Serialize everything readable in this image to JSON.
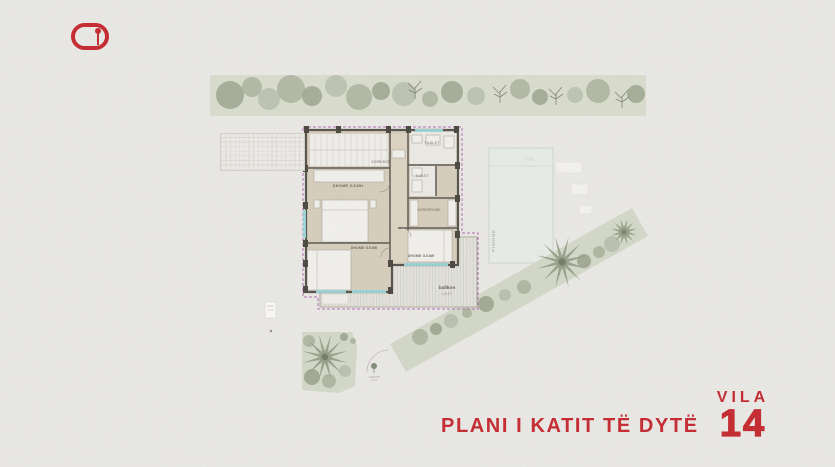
{
  "header": {
    "logo_icon": "brand-pill-key-icon"
  },
  "floor_plan": {
    "rooms": {
      "bedroom_left": "DHOME GJUMI",
      "bedroom_bottom": "DHOME GJUMI",
      "bedroom_right": "DHOME GJUMI",
      "corridor": "KORRIDOR",
      "toilet_top": "TUALET",
      "toilet_mid": "TUALET",
      "wardrobe": "GARDEROBE"
    },
    "balcony": {
      "label": "ballkon",
      "elevation": "± 5.27"
    },
    "pool": {
      "label": "PISHINE"
    }
  },
  "footer": {
    "plan_title": "PLANI I KATIT TË DYTË",
    "villa_label": "VILA",
    "villa_number": "14"
  },
  "colors": {
    "accent_red": "#c4232a",
    "boundary_purple": "#b06ab0",
    "wall_dark": "#514e47",
    "floor_beige": "#d7cdbb",
    "vegetation_green": "#d3d8c8",
    "tree_green": "#9aa48d",
    "pool_pale": "#e7ede9",
    "window_teal": "#9ad6da",
    "paper": "#eae9e6"
  }
}
